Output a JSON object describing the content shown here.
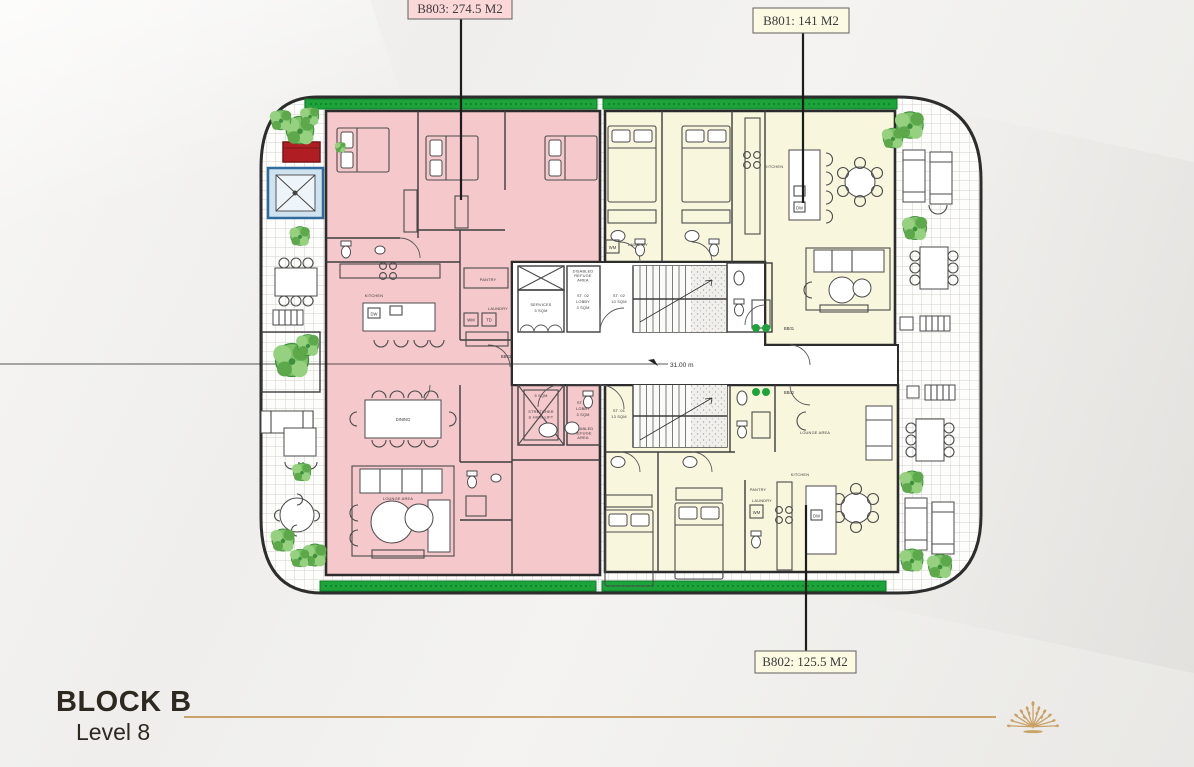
{
  "title": {
    "block": "BLOCK B",
    "level": "Level 8"
  },
  "accent": {
    "gold": "#c9a36a",
    "text_dark": "#2e2920"
  },
  "units": {
    "b803": {
      "label": "B803: 274.5 M2",
      "color": "#f5c8cb",
      "label_bg": "#fbd7d8"
    },
    "b801": {
      "label": "B801: 141 M2",
      "color": "#f8f6dd",
      "label_bg": "#fcfae3"
    },
    "b802": {
      "label": "B802: 125.5 M2",
      "color": "#f8f6dd",
      "label_bg": "#fcfae3"
    }
  },
  "landscape": {
    "hedge": "#1ca43b",
    "plant": "#7cc268",
    "planter_red": "#b01e23",
    "jacuzzi_blue": "#cfe2ef"
  },
  "rooms": {
    "b803_kitchen": "KITCHEN",
    "b803_dining": "DINING",
    "b803_lounge": "LOUNGE AREA",
    "b803_pantry": "PANTRY",
    "b803_laundry": "LAUNDRY",
    "b803_wm": "WM",
    "b803_td": "TD",
    "b803_dw": "DW",
    "b803_door": "BB03",
    "b801_kitchen": "KITCHEN",
    "b801_laundry": "LAUNDRY",
    "b801_wm": "WM",
    "b801_dw": "DW",
    "b801_door": "BB01",
    "b802_kitchen": "KITCHEN",
    "b802_lounge": "LOUNGE AREA",
    "b802_pantry": "PANTRY",
    "b802_laundry": "LAUNDRY",
    "b802_wm": "WM",
    "b802_dw": "DW",
    "b802_door": "BB02"
  },
  "core": {
    "services_1": "SERVICES",
    "services_2": "5 SQM",
    "st02_lobby_1": "ST. 02",
    "st02_lobby_2": "LOBBY",
    "st02_lobby_3": "3 SQM",
    "st02_stair_1": "ST. 02",
    "st02_stair_2": "10 SQM",
    "st01_lobby_1": "ST. 01",
    "st01_lobby_2": "LOBBY",
    "st01_lobby_3": "3 SQM",
    "st01_stair_1": "ST. 01",
    "st01_stair_2": "13 SQM",
    "lift_1": "5 SQM",
    "lift_2": "STRETCHER",
    "lift_3": "& HIGH LIFT",
    "refuge_1": "DISABLED",
    "refuge_2": "REFUGE",
    "refuge_3": "AREA",
    "dim": "31.00 m"
  }
}
